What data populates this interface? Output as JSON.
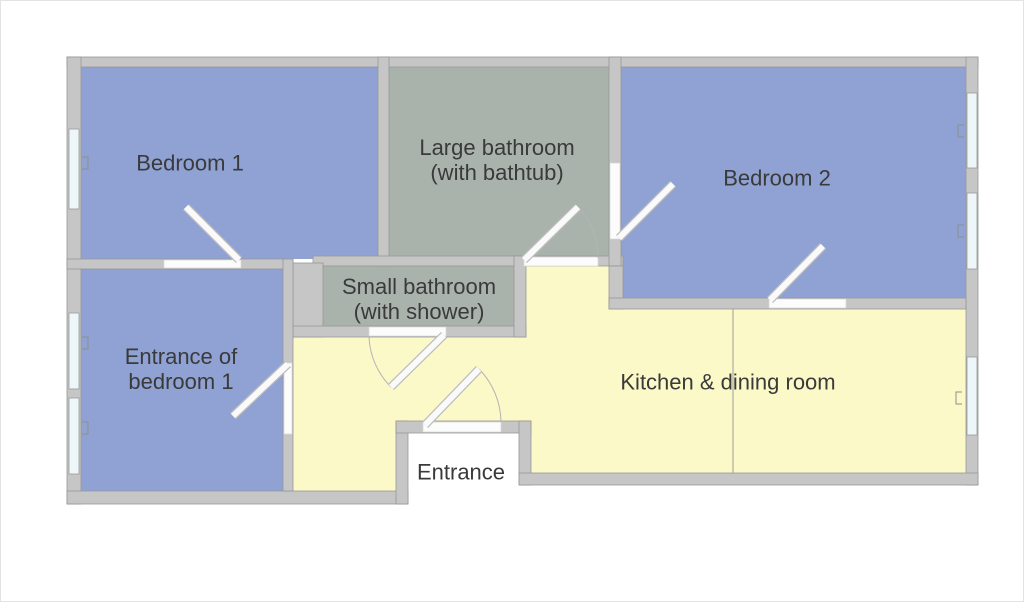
{
  "title": "Apartment floor plan",
  "colors": {
    "bedroom": "#8FA2D3",
    "bathroom": "#A9B3AC",
    "living": "#FBF9C7",
    "wall": "#C6C6C6",
    "window_glass": "#EDF7F9",
    "door_white": "#FCFCFC",
    "recess_white": "#FFFFFF",
    "label_text": "#3A3A3A"
  },
  "rooms": {
    "bedroom1": {
      "label": "Bedroom 1"
    },
    "large_bathroom": {
      "label": "Large bathroom\n(with bathtub)"
    },
    "bedroom2": {
      "label": "Bedroom 2"
    },
    "small_bathroom": {
      "label": "Small bathroom\n(with shower)"
    },
    "entrance_bedroom1": {
      "label": "Entrance of\nbedroom 1"
    },
    "kitchen": {
      "label": "Kitchen & dining room"
    },
    "entrance": {
      "label": "Entrance"
    }
  }
}
